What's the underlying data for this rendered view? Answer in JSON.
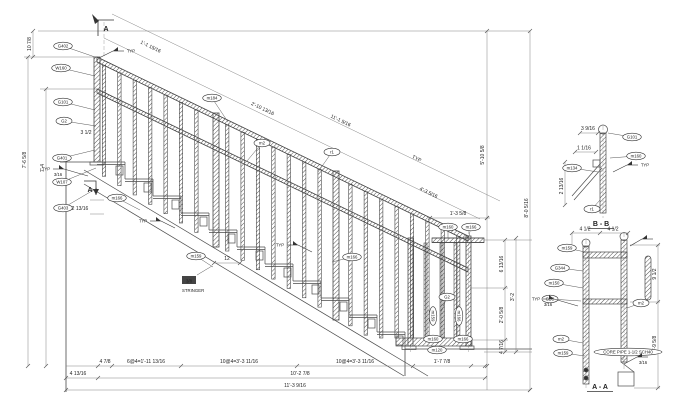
{
  "labels": {
    "typ": "TYP",
    "weld_size": "3/16",
    "section_marker": "A",
    "stringer_plate": "3/8",
    "stringer": "STRINGER",
    "tread_dim": "12"
  },
  "dims": {
    "top_offset": "10 7/8",
    "slope_seg1": "1'-1 15/16",
    "slope_seg2": "2'-10 13/16",
    "slope_total1": "11'-1 5/16",
    "slope_seg3": "4'-3 5/16",
    "left_height1": "7'-6 5/8",
    "left_height2": "7'-4",
    "left_small1": "3 1/2",
    "left_small2": "2 13/16",
    "chain1": "4 7/8",
    "chain2": "6@4=1'-11 13/16",
    "chain3": "10@4=3'-3 11/16",
    "chain4": "10@4=3'-3 11/16",
    "chain5": "1'-7 7/8",
    "bottom_left": "4 13/16",
    "bottom_total1": "10'-2 7/8",
    "bottom_total2": "11'-3 9/16",
    "right_top": "1'-3 5/8",
    "right_height1": "5'-10 5/8",
    "right_height2": "8'-0 5/16",
    "right_small1": "6 13/16",
    "right_small2": "2'-0 5/8",
    "right_small3": "4 7/16",
    "right_mid": "3'-2"
  },
  "callouts": [
    {
      "label": "G402",
      "x": 63,
      "y": 46,
      "tx": 95,
      "ty": 57
    },
    {
      "label": "W160",
      "x": 61,
      "y": 68,
      "tx": 95,
      "ty": 76
    },
    {
      "label": "G101",
      "x": 63,
      "y": 102,
      "tx": 95,
      "ty": 110
    },
    {
      "label": "G2",
      "x": 64,
      "y": 121,
      "tx": 96,
      "ty": 126
    },
    {
      "label": "G401",
      "x": 62,
      "y": 158,
      "tx": 95,
      "ty": 150
    },
    {
      "label": "W107",
      "x": 62,
      "y": 182,
      "tx": 96,
      "ty": 168
    },
    {
      "label": "G403",
      "x": 63,
      "y": 208,
      "tx": 97,
      "ty": 188
    },
    {
      "label": "m184",
      "x": 212,
      "y": 98,
      "tx": 228,
      "ty": 122
    },
    {
      "label": "m2",
      "x": 262,
      "y": 143,
      "tx": 247,
      "ty": 161
    },
    {
      "label": "r1",
      "x": 332,
      "y": 152,
      "tx": 318,
      "ty": 172
    },
    {
      "label": "m166",
      "x": 117,
      "y": 198,
      "tx": 140,
      "ty": 210
    },
    {
      "label": "m159",
      "x": 196,
      "y": 256,
      "tx": 213,
      "ty": 267
    },
    {
      "label": "m166",
      "x": 352,
      "y": 257,
      "tx": 332,
      "ty": 262
    },
    {
      "label": "m160",
      "x": 448,
      "y": 227,
      "tx": 448,
      "ty": 238
    },
    {
      "label": "m166",
      "x": 471,
      "y": 227,
      "tx": 468,
      "ty": 240
    },
    {
      "label": "G2",
      "x": 447,
      "y": 297,
      "tx": 441,
      "ty": 312
    },
    {
      "label": "m159",
      "x": 433,
      "y": 316,
      "rot": 90
    },
    {
      "label": "m166",
      "x": 459,
      "y": 316,
      "rot": 90
    },
    {
      "label": "m160",
      "x": 433,
      "y": 339
    },
    {
      "label": "m166",
      "x": 463,
      "y": 339
    },
    {
      "label": "m120",
      "x": 437,
      "y": 350
    }
  ],
  "section_bb": {
    "title": "B - B",
    "dim1": "3 9/16",
    "dim2": "1 1/16",
    "dim3": "2 13/16",
    "callouts": [
      {
        "label": "G101",
        "x": 632,
        "y": 137,
        "tx": 608,
        "ty": 133
      },
      {
        "label": "m160",
        "x": 636,
        "y": 156,
        "tx": 610,
        "ty": 158
      },
      {
        "label": "m134",
        "x": 572,
        "y": 168,
        "tx": 598,
        "ty": 172
      },
      {
        "label": "r1",
        "x": 592,
        "y": 209,
        "tx": 600,
        "ty": 200
      }
    ]
  },
  "section_aa": {
    "title": "A - A",
    "dim1": "4 1/2",
    "dim2": "4 1/2",
    "dim3": "9 1/2",
    "dim4": "1'-9 5/8",
    "note": "CORE PIPE 1-1/2 SCH40",
    "callouts": [
      {
        "label": "m159",
        "x": 567,
        "y": 248,
        "tx": 585,
        "ty": 252
      },
      {
        "label": "G344",
        "x": 560,
        "y": 268,
        "tx": 583,
        "ty": 271
      },
      {
        "label": "m150",
        "x": 554,
        "y": 283,
        "tx": 583,
        "ty": 288
      },
      {
        "label": "G2C",
        "x": 550,
        "y": 299,
        "tx": 581,
        "ty": 301
      },
      {
        "label": "m2",
        "x": 561,
        "y": 339,
        "tx": 583,
        "ty": 343
      },
      {
        "label": "m159",
        "x": 563,
        "y": 353,
        "tx": 585,
        "ty": 356
      },
      {
        "label": "m2",
        "x": 641,
        "y": 303,
        "tx": 627,
        "ty": 308
      },
      {
        "label": "CORE PIPE 1-1/2 SCH40",
        "x": 628,
        "y": 352,
        "tx": 622,
        "ty": 360
      }
    ]
  }
}
